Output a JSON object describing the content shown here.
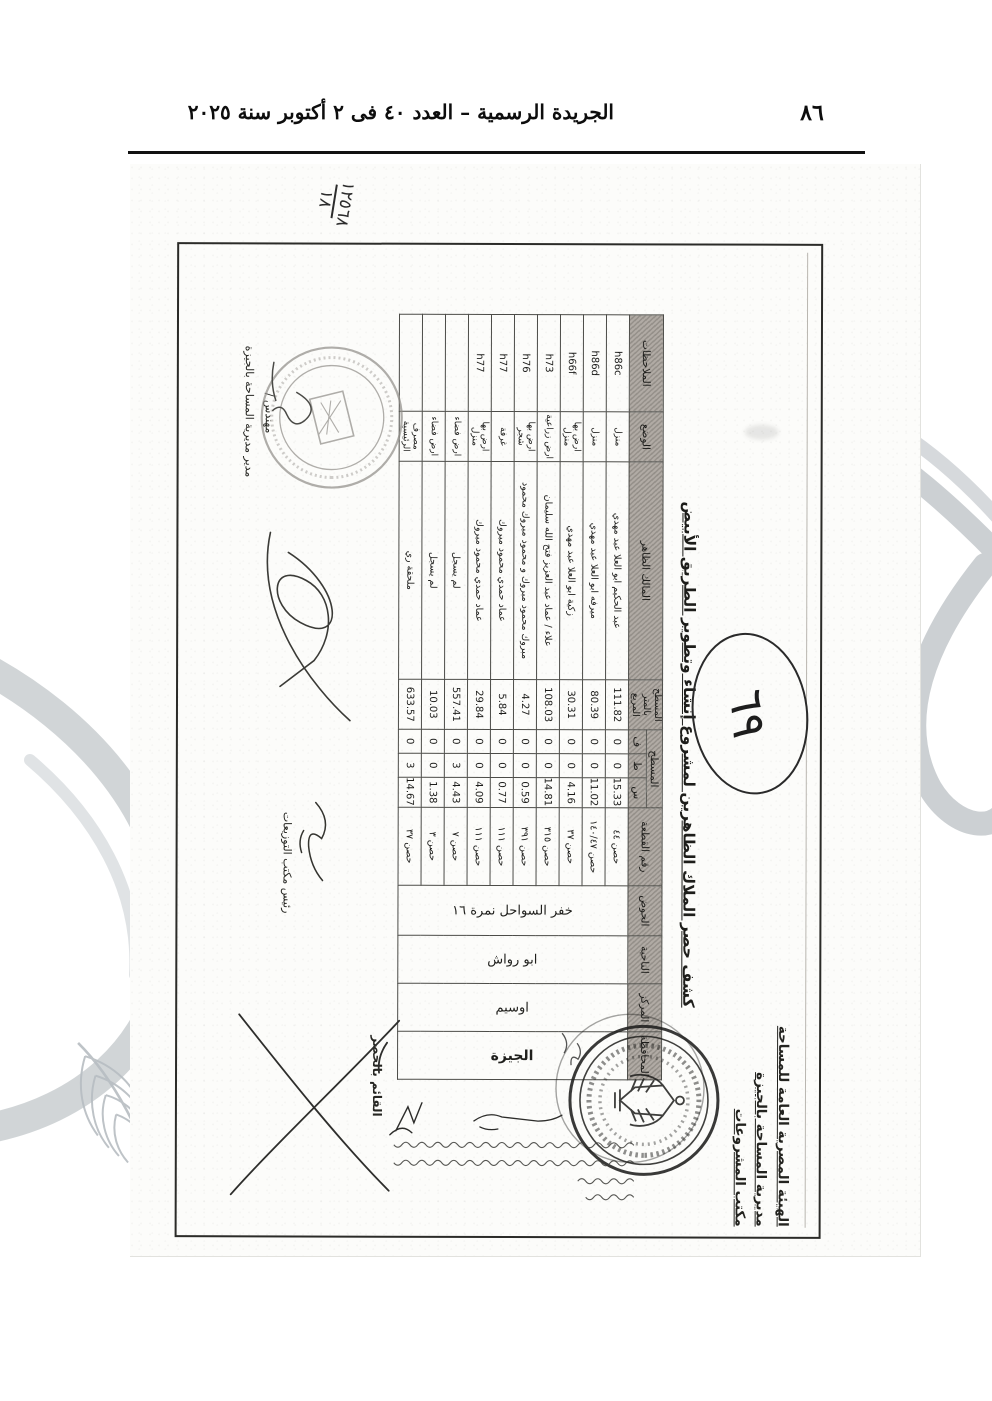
{
  "gazette": {
    "header_title": "الجريدة الرسمية – العدد ٤٠ فى ٢ أكتوبر سنة ٢٠٢٥",
    "page_number": "٨٦"
  },
  "scan": {
    "handwritten_ref_top": "١٢٥٦٨",
    "handwritten_ref_bottom": "١٨",
    "circled_annotation": "٦٩",
    "letterhead": [
      "الهيئة المصرية العامة للمساحة",
      "مديرية المساحة بالجيزة",
      "مكتب المشروعات"
    ],
    "doc_title": "كشف حصر الملاك الظاهرين لمشروع إنشاء وتطوير الطريق الأبيض",
    "table": {
      "headers": {
        "governorate": "المحافظة",
        "center": "المركز",
        "district": "الناحية",
        "basin": "الحوض",
        "parcel": "رقم القطعة",
        "area_group": "المسطح",
        "sahm": "س",
        "qirat": "ط",
        "feddan": "ف",
        "area_m2_line1": "المسطح",
        "area_m2_line2": "بالمتر المربع",
        "owner": "المالك الظاهر",
        "description": "الوضع",
        "notes": "الملاحظات"
      },
      "location": {
        "governorate": "الجيزة",
        "center": "اوسيم",
        "district": "ابو رواش",
        "basin": "خفر السواحل نمرة ١٦"
      },
      "rows": [
        {
          "parcel": "حصن ٤٤",
          "s": "15.33",
          "t": "0",
          "f": "0",
          "m2": "111.82",
          "owner": "عبد الحكيم ابو العلا عبد مهدي",
          "desc": "منزل",
          "notes": "h86c"
        },
        {
          "parcel": "حصن ١٤٠/٤٧",
          "s": "11.02",
          "t": "0",
          "f": "0",
          "m2": "80.39",
          "owner": "ميرفه ابو العلا عبد مهدي",
          "desc": "منزل",
          "notes": "h86d"
        },
        {
          "parcel": "حصن ٣٧",
          "s": "4.16",
          "t": "0",
          "f": "0",
          "m2": "30.31",
          "owner": "زكية ابو العلا عبد مهدي",
          "desc": "ارض بها منزل",
          "notes": "h66f"
        },
        {
          "parcel": "حصن ٣١٥",
          "s": "14.81",
          "t": "0",
          "f": "0",
          "m2": "108.03",
          "owner": "علاء / عماد عبد العزيز فتح الله سليمان",
          "desc": "ارض زراعية",
          "notes": "h73"
        },
        {
          "parcel": "حصن ٣٩١",
          "s": "0.59",
          "t": "0",
          "f": "0",
          "m2": "4.27",
          "owner": "مبروك محمود مبروك و محمود مبروك محمود",
          "desc": "ارض بها شجر",
          "notes": "h76"
        },
        {
          "parcel": "حصن ١١١",
          "s": "0.77",
          "t": "0",
          "f": "0",
          "m2": "5.84",
          "owner": "عماد حمدي محمود مبروك",
          "desc": "غرفة",
          "notes": "h77"
        },
        {
          "parcel": "حصن ١١١",
          "s": "4.09",
          "t": "0",
          "f": "0",
          "m2": "29.84",
          "owner": "عماد حمدي محمود مبروك",
          "desc": "ارض بها منزل",
          "notes": "h77"
        },
        {
          "parcel": "حصن ٧",
          "s": "4.43",
          "t": "3",
          "f": "0",
          "m2": "557.41",
          "owner": "لم يسجل",
          "desc": "ارض فضاء",
          "notes": ""
        },
        {
          "parcel": "حصن ٣",
          "s": "1.38",
          "t": "0",
          "f": "0",
          "m2": "10.03",
          "owner": "لم يسجل",
          "desc": "ارض فضاء",
          "notes": ""
        },
        {
          "parcel": "حصن ٣٧",
          "s": "14.67",
          "t": "3",
          "f": "0",
          "m2": "633.57",
          "owner": "ملحقة ري",
          "desc": "مصرف الرئيسية",
          "notes": ""
        }
      ]
    },
    "signatures": {
      "surveyor_label": "القائم بالحصر",
      "distribution_head_label": "رئيس مكتب التوزيعات",
      "director_prefix": "مهندس /",
      "director_label": "مدير مديرية المساحة بالجيزة"
    }
  }
}
